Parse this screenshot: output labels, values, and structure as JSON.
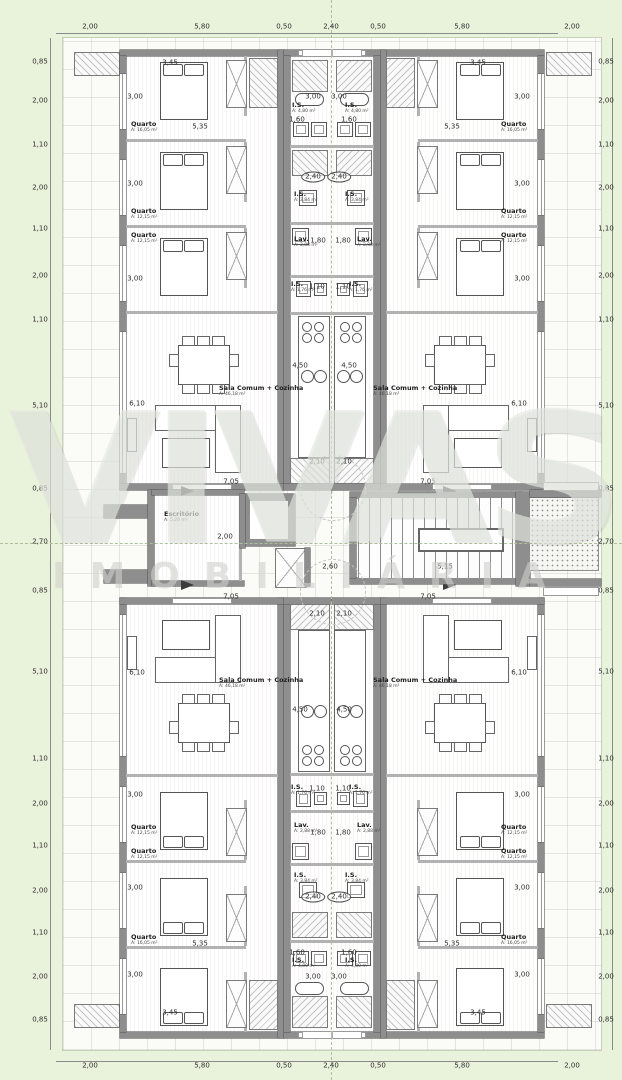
{
  "watermark": {
    "line1": "VIVAS",
    "line2": "IMOBILIÁRIA"
  },
  "dim_labels": [
    {
      "t": "2,00",
      "x": 90,
      "y": 27
    },
    {
      "t": "5,80",
      "x": 202,
      "y": 27
    },
    {
      "t": "0,50",
      "x": 284,
      "y": 27
    },
    {
      "t": "2,40",
      "x": 331,
      "y": 27
    },
    {
      "t": "0,50",
      "x": 378,
      "y": 27
    },
    {
      "t": "5,80",
      "x": 462,
      "y": 27
    },
    {
      "t": "2,00",
      "x": 572,
      "y": 27
    },
    {
      "t": "2,00",
      "x": 90,
      "y": 1066
    },
    {
      "t": "5,80",
      "x": 202,
      "y": 1066
    },
    {
      "t": "0,50",
      "x": 284,
      "y": 1066
    },
    {
      "t": "2,40",
      "x": 331,
      "y": 1066
    },
    {
      "t": "0,50",
      "x": 378,
      "y": 1066
    },
    {
      "t": "5,80",
      "x": 462,
      "y": 1066
    },
    {
      "t": "2,00",
      "x": 572,
      "y": 1066
    },
    {
      "t": "0,85",
      "x": 40,
      "y": 62
    },
    {
      "t": "2,00",
      "x": 40,
      "y": 101
    },
    {
      "t": "1,10",
      "x": 40,
      "y": 145
    },
    {
      "t": "2,00",
      "x": 40,
      "y": 188
    },
    {
      "t": "1,10",
      "x": 40,
      "y": 229
    },
    {
      "t": "2,00",
      "x": 40,
      "y": 276
    },
    {
      "t": "1,10",
      "x": 40,
      "y": 320
    },
    {
      "t": "5,10",
      "x": 40,
      "y": 406
    },
    {
      "t": "0,85",
      "x": 40,
      "y": 489
    },
    {
      "t": "2,70",
      "x": 40,
      "y": 542
    },
    {
      "t": "0,85",
      "x": 40,
      "y": 591
    },
    {
      "t": "5,10",
      "x": 40,
      "y": 672
    },
    {
      "t": "1,10",
      "x": 40,
      "y": 759
    },
    {
      "t": "2,00",
      "x": 40,
      "y": 804
    },
    {
      "t": "1,10",
      "x": 40,
      "y": 846
    },
    {
      "t": "2,00",
      "x": 40,
      "y": 891
    },
    {
      "t": "1,10",
      "x": 40,
      "y": 933
    },
    {
      "t": "2,00",
      "x": 40,
      "y": 977
    },
    {
      "t": "0,85",
      "x": 40,
      "y": 1020
    },
    {
      "t": "0,85",
      "x": 606,
      "y": 62
    },
    {
      "t": "2,00",
      "x": 606,
      "y": 101
    },
    {
      "t": "1,10",
      "x": 606,
      "y": 145
    },
    {
      "t": "2,00",
      "x": 606,
      "y": 188
    },
    {
      "t": "1,10",
      "x": 606,
      "y": 229
    },
    {
      "t": "2,00",
      "x": 606,
      "y": 276
    },
    {
      "t": "1,10",
      "x": 606,
      "y": 320
    },
    {
      "t": "5,10",
      "x": 606,
      "y": 406
    },
    {
      "t": "0,85",
      "x": 606,
      "y": 489
    },
    {
      "t": "2,70",
      "x": 606,
      "y": 542
    },
    {
      "t": "0,85",
      "x": 606,
      "y": 591
    },
    {
      "t": "5,10",
      "x": 606,
      "y": 672
    },
    {
      "t": "1,10",
      "x": 606,
      "y": 759
    },
    {
      "t": "2,00",
      "x": 606,
      "y": 804
    },
    {
      "t": "1,10",
      "x": 606,
      "y": 846
    },
    {
      "t": "2,00",
      "x": 606,
      "y": 891
    },
    {
      "t": "1,10",
      "x": 606,
      "y": 933
    },
    {
      "t": "2,00",
      "x": 606,
      "y": 977
    },
    {
      "t": "0,85",
      "x": 606,
      "y": 1020
    },
    {
      "t": "3,45",
      "x": 170,
      "y": 63
    },
    {
      "t": "3,45",
      "x": 478,
      "y": 63
    },
    {
      "t": "3,00",
      "x": 135,
      "y": 97
    },
    {
      "t": "3,00",
      "x": 522,
      "y": 97
    },
    {
      "t": "3,00",
      "x": 313,
      "y": 97
    },
    {
      "t": "3,00",
      "x": 339,
      "y": 97
    },
    {
      "t": "1,60",
      "x": 297,
      "y": 120
    },
    {
      "t": "1,60",
      "x": 349,
      "y": 120
    },
    {
      "t": "5,35",
      "x": 200,
      "y": 127
    },
    {
      "t": "5,35",
      "x": 452,
      "y": 127
    },
    {
      "t": "2,40",
      "x": 313,
      "y": 177,
      "cls": "oval"
    },
    {
      "t": "2,40",
      "x": 339,
      "y": 177,
      "cls": "oval"
    },
    {
      "t": "3,00",
      "x": 135,
      "y": 184
    },
    {
      "t": "3,00",
      "x": 522,
      "y": 184
    },
    {
      "t": "1,80",
      "x": 318,
      "y": 241
    },
    {
      "t": "1,80",
      "x": 343,
      "y": 241
    },
    {
      "t": "3,00",
      "x": 135,
      "y": 279
    },
    {
      "t": "3,00",
      "x": 522,
      "y": 279
    },
    {
      "t": "1,10",
      "x": 317,
      "y": 287
    },
    {
      "t": "1,10",
      "x": 343,
      "y": 287
    },
    {
      "t": "4,50",
      "x": 300,
      "y": 366
    },
    {
      "t": "4,50",
      "x": 349,
      "y": 366
    },
    {
      "t": "6,10",
      "x": 137,
      "y": 404
    },
    {
      "t": "6,10",
      "x": 519,
      "y": 404
    },
    {
      "t": "2,10",
      "x": 317,
      "y": 462
    },
    {
      "t": "2,10",
      "x": 344,
      "y": 462
    },
    {
      "t": "7,05",
      "x": 231,
      "y": 482
    },
    {
      "t": "7,05",
      "x": 428,
      "y": 482
    },
    {
      "t": "2,00",
      "x": 225,
      "y": 537
    },
    {
      "t": "2,60",
      "x": 330,
      "y": 567
    },
    {
      "t": "5,15",
      "x": 445,
      "y": 567
    },
    {
      "t": "7,05",
      "x": 231,
      "y": 597
    },
    {
      "t": "7,05",
      "x": 428,
      "y": 597
    },
    {
      "t": "2,10",
      "x": 317,
      "y": 614
    },
    {
      "t": "2,10",
      "x": 344,
      "y": 614
    },
    {
      "t": "6,10",
      "x": 137,
      "y": 673
    },
    {
      "t": "6,10",
      "x": 519,
      "y": 673
    },
    {
      "t": "4,50",
      "x": 300,
      "y": 710
    },
    {
      "t": "4,50",
      "x": 344,
      "y": 710
    },
    {
      "t": "1,10",
      "x": 317,
      "y": 789
    },
    {
      "t": "1,10",
      "x": 343,
      "y": 789
    },
    {
      "t": "3,00",
      "x": 135,
      "y": 795
    },
    {
      "t": "3,00",
      "x": 522,
      "y": 795
    },
    {
      "t": "1,80",
      "x": 318,
      "y": 833
    },
    {
      "t": "1,80",
      "x": 343,
      "y": 833
    },
    {
      "t": "3,00",
      "x": 135,
      "y": 888
    },
    {
      "t": "3,00",
      "x": 522,
      "y": 888
    },
    {
      "t": "2,40",
      "x": 313,
      "y": 897,
      "cls": "oval"
    },
    {
      "t": "2,40",
      "x": 339,
      "y": 897,
      "cls": "oval"
    },
    {
      "t": "5,35",
      "x": 200,
      "y": 944
    },
    {
      "t": "5,35",
      "x": 452,
      "y": 944
    },
    {
      "t": "1,60",
      "x": 297,
      "y": 953
    },
    {
      "t": "1,60",
      "x": 349,
      "y": 953
    },
    {
      "t": "3,00",
      "x": 135,
      "y": 975
    },
    {
      "t": "3,00",
      "x": 522,
      "y": 975
    },
    {
      "t": "3,00",
      "x": 313,
      "y": 977
    },
    {
      "t": "3,00",
      "x": 339,
      "y": 977
    },
    {
      "t": "3,45",
      "x": 170,
      "y": 1013
    },
    {
      "t": "3,45",
      "x": 478,
      "y": 1013
    }
  ],
  "room_labels": [
    {
      "t": "Quarto",
      "sub": "A: 16,05 m²",
      "x": 131,
      "y": 121
    },
    {
      "t": "Quarto",
      "sub": "A: 16,05 m²",
      "x": 501,
      "y": 121
    },
    {
      "t": "I.S.",
      "sub": "A: 4,80 m²",
      "x": 292,
      "y": 102
    },
    {
      "t": "I.S.",
      "sub": "A: 4,80 m²",
      "x": 345,
      "y": 102
    },
    {
      "t": "I.S.",
      "sub": "A: 3,84 m²",
      "x": 294,
      "y": 191
    },
    {
      "t": "I.S.",
      "sub": "A: 3,84 m²",
      "x": 345,
      "y": 191
    },
    {
      "t": "Quarto",
      "sub": "A: 12,15 m²",
      "x": 131,
      "y": 208
    },
    {
      "t": "Quarto",
      "sub": "A: 12,15 m²",
      "x": 501,
      "y": 208
    },
    {
      "t": "Quarto",
      "sub": "A: 12,15 m²",
      "x": 131,
      "y": 232
    },
    {
      "t": "Quarto",
      "sub": "A: 12,15 m²",
      "x": 501,
      "y": 232
    },
    {
      "t": "Lav.",
      "sub": "A: 2,88 m²",
      "x": 294,
      "y": 236
    },
    {
      "t": "Lav.",
      "sub": "A: 2,88 m²",
      "x": 357,
      "y": 236
    },
    {
      "t": "I.S.",
      "sub": "A: 1,76 m²",
      "x": 291,
      "y": 281
    },
    {
      "t": "I.S.",
      "sub": "A: 1,76 m²",
      "x": 349,
      "y": 281
    },
    {
      "t": "Sala Comum + Cozinha",
      "sub": "A: 46,18 m²",
      "x": 219,
      "y": 385
    },
    {
      "t": "Sala Comum + Cozinha",
      "sub": "A: 46,18 m²",
      "x": 373,
      "y": 385
    },
    {
      "t": "Escritório",
      "sub": "A: 5,20 m²",
      "x": 164,
      "y": 511
    },
    {
      "t": "Sala Comum + Cozinha",
      "sub": "A: 46,18 m²",
      "x": 219,
      "y": 677
    },
    {
      "t": "Sala Comum + Cozinha",
      "sub": "A: 46,18 m²",
      "x": 373,
      "y": 677
    },
    {
      "t": "I.S.",
      "sub": "A: 1,76 m²",
      "x": 291,
      "y": 784
    },
    {
      "t": "I.S.",
      "sub": "A: 1,76 m²",
      "x": 349,
      "y": 784
    },
    {
      "t": "Lav.",
      "sub": "A: 2,88 m²",
      "x": 294,
      "y": 822
    },
    {
      "t": "Lav.",
      "sub": "A: 2,88 m²",
      "x": 357,
      "y": 822
    },
    {
      "t": "Quarto",
      "sub": "A: 12,15 m²",
      "x": 131,
      "y": 824
    },
    {
      "t": "Quarto",
      "sub": "A: 12,15 m²",
      "x": 501,
      "y": 824
    },
    {
      "t": "Quarto",
      "sub": "A: 12,15 m²",
      "x": 131,
      "y": 848
    },
    {
      "t": "Quarto",
      "sub": "A: 12,15 m²",
      "x": 501,
      "y": 848
    },
    {
      "t": "I.S.",
      "sub": "A: 3,84 m²",
      "x": 294,
      "y": 872
    },
    {
      "t": "I.S.",
      "sub": "A: 3,84 m²",
      "x": 345,
      "y": 872
    },
    {
      "t": "Quarto",
      "sub": "A: 16,05 m²",
      "x": 131,
      "y": 934
    },
    {
      "t": "Quarto",
      "sub": "A: 16,05 m²",
      "x": 501,
      "y": 934
    },
    {
      "t": "I.S.",
      "sub": "A: 4,80 m²",
      "x": 292,
      "y": 957
    },
    {
      "t": "I.S.",
      "sub": "A: 4,80 m²",
      "x": 345,
      "y": 957
    }
  ]
}
